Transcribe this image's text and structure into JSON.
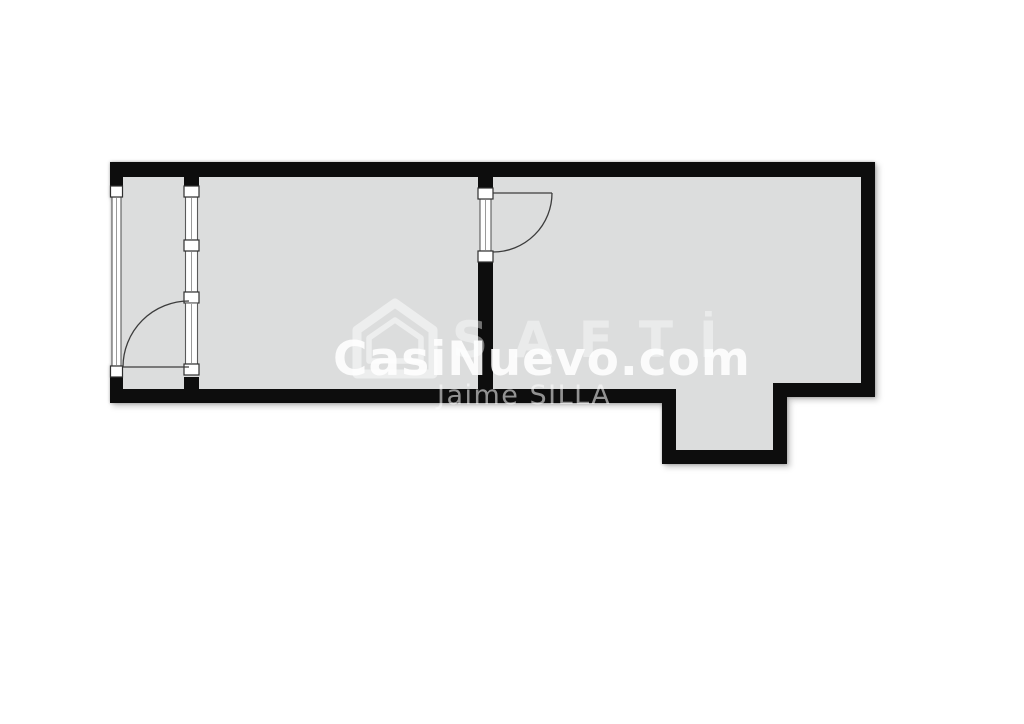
{
  "colors": {
    "background": "#ffffff",
    "wall": "#0d0d0d",
    "floor": "#dcdddd",
    "door_line": "#3c3c3c",
    "watermark_white": "#ffffff"
  },
  "watermark": {
    "site_name": "CasiNuevo.com",
    "agency_name": "SAFTİ",
    "agent_name": "Jaime SILLA",
    "house_icon": "house-outline-icon"
  },
  "plan": {
    "kind": "floor-plan",
    "features": [
      "glazed-gallery-left",
      "gallery-swing-door",
      "center-partition-swing-door",
      "main-room-right",
      "bottom-recess-right"
    ]
  }
}
